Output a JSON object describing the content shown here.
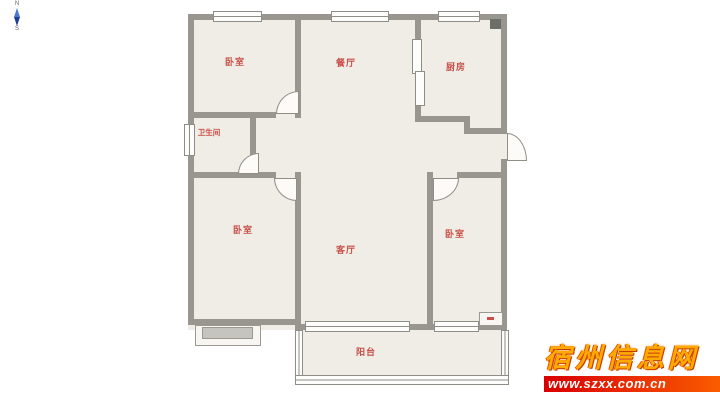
{
  "compass": {
    "north": "N",
    "south": "S"
  },
  "floorplan": {
    "rooms": {
      "bedroom_top_left": "卧室",
      "dining": "餐厅",
      "kitchen": "厨房",
      "bathroom": "卫生间",
      "bedroom_bottom_left": "卧室",
      "living": "客厅",
      "bedroom_right": "卧室",
      "balcony": "阳台"
    },
    "colors": {
      "room_fill": "#EFEDE5",
      "wall": "#98968F",
      "label": "#C94F48",
      "window_fill": "#FDFDFB",
      "flue": "#6E6E68"
    }
  },
  "watermark": {
    "site_name": "宿州信息网",
    "url": "www.szxx.com.cn",
    "colors": {
      "title": "#FFAA00",
      "banner_start": "#D90000",
      "banner_end": "#FF6A00",
      "url_text": "#FFFFFF"
    }
  }
}
